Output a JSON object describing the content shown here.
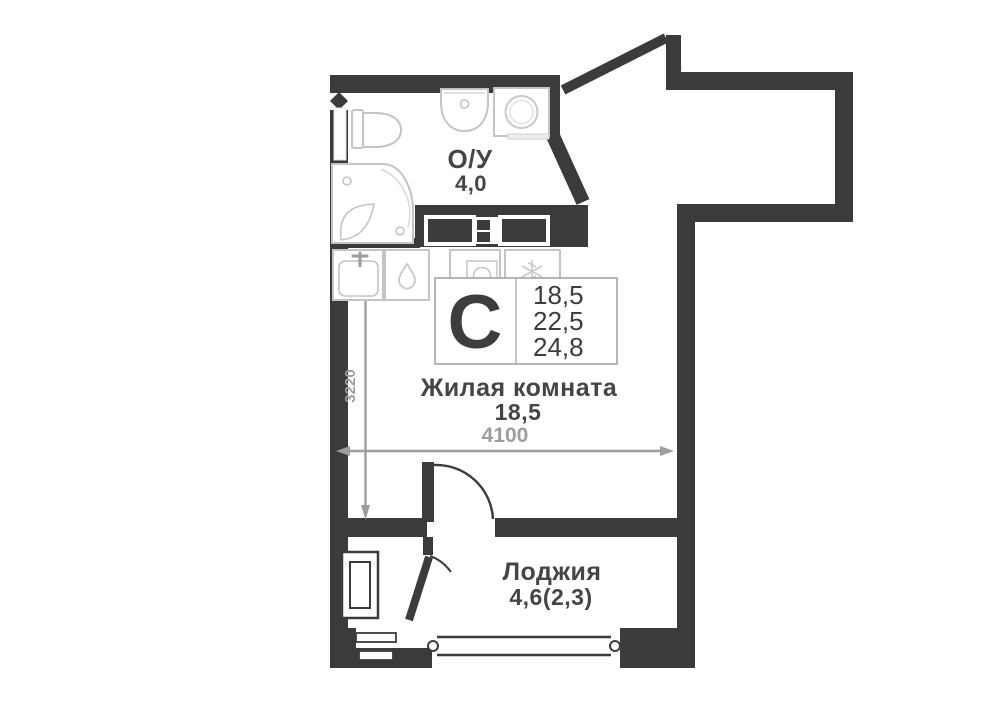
{
  "unit_card": {
    "type_letter": "С",
    "areas": [
      "18,5",
      "22,5",
      "24,8"
    ]
  },
  "rooms": {
    "bathroom": {
      "name": "О/У",
      "area": "4,0"
    },
    "living": {
      "name": "Жилая комната",
      "area": "18,5"
    },
    "loggia": {
      "name": "Лоджия",
      "area": "4,6(2,3)"
    }
  },
  "dimensions": {
    "horizontal": "4100",
    "vertical": "3220"
  },
  "colors": {
    "wall": "#3b3b3b",
    "dimension": "#9d9d9d",
    "label_text": "#454545",
    "fixture_stroke": "#c4c4c4",
    "card_border": "#9e9e9e",
    "background": "#ffffff"
  },
  "icons": {
    "vent-icon": "diamond",
    "water-drop-icon": "drop-outline",
    "snowflake-icon": "six-spoke-asterisk",
    "washer-drum-icon": "circle-in-square",
    "faucet-icon": "tap-glyph",
    "door-swing-icon": "quarter-arc",
    "dimension-arrow-icon": "triangle",
    "loggia-glazing-icon": "double-line-with-rings"
  }
}
